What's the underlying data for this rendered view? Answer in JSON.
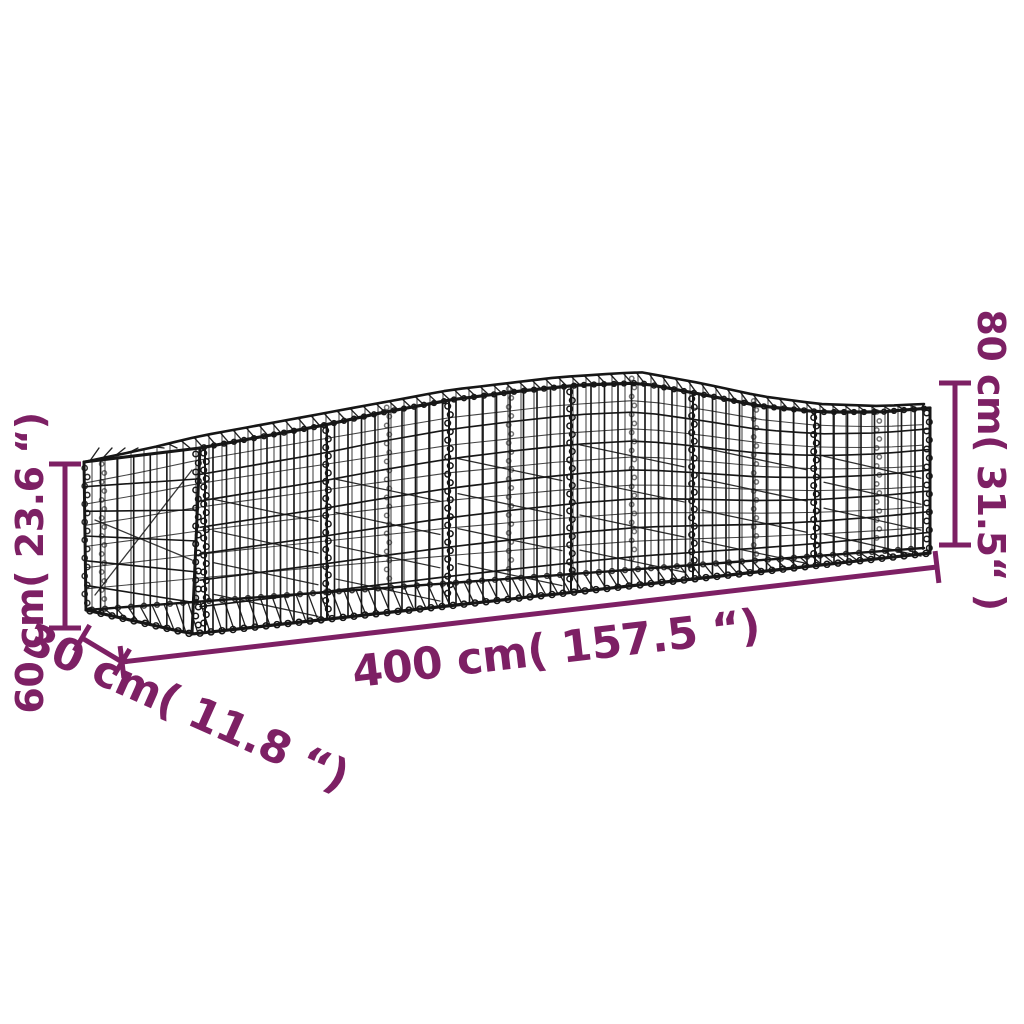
{
  "diagram": {
    "title": "Arched gabion basket dimension diagram",
    "background_color": "#ffffff",
    "wire_color": "#161616",
    "annotation_color": "#7D2064",
    "labels": {
      "height_left": "60 cm( 23.6 “)",
      "depth": "30 cm( 11.8 “)",
      "length": "400 cm( 157.5 “)",
      "height_right": "80 cm( 31.5“ )"
    },
    "values": {
      "length_cm": 400,
      "depth_cm": 30,
      "height_end_cm": 60,
      "height_peak_cm": 80,
      "length_in": 157.5,
      "depth_in": 11.8,
      "height_end_in": 23.6,
      "height_peak_in": 31.5
    }
  }
}
